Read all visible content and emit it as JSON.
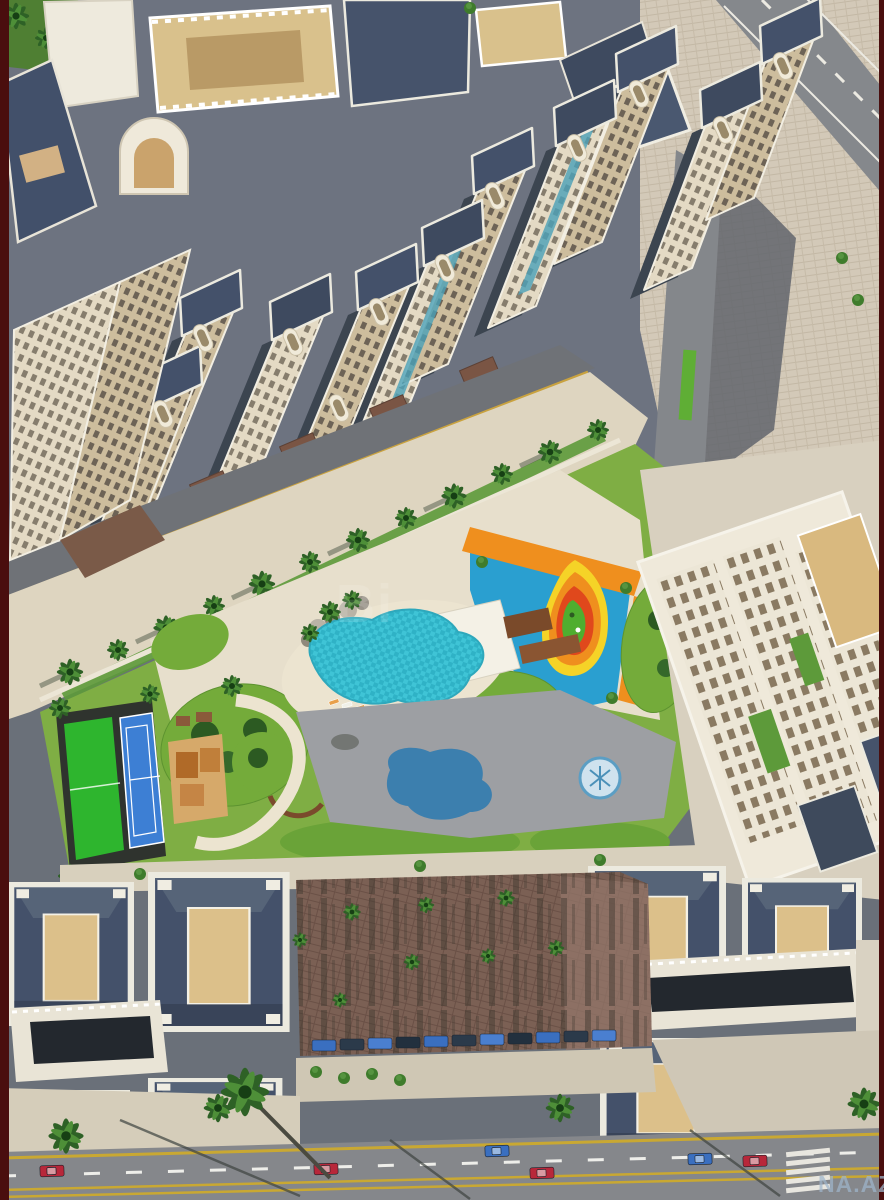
{
  "scene": {
    "type": "aerial-3d-render",
    "subject": "residential-complex-masterplan",
    "elements": [
      "high-rise-towers",
      "palm-promenade",
      "swimming-pool",
      "kids-playground",
      "tennis-court",
      "mini-football-pitch",
      "lawn-mounds",
      "paved-plaza",
      "right-residential-building",
      "parking-plaza",
      "bottom-street",
      "crosswalk"
    ]
  },
  "watermarks": {
    "center": "Bi",
    "bottom_right": "NA.AZ"
  },
  "palette": {
    "frame_maroon": "#4a0e0e",
    "roof_slate": "#44516a",
    "facade_beige": "#cdbd9d",
    "facade_cream": "#e9e3d3",
    "deck_tan": "#dcc08a",
    "lawn_green": "#7fae44",
    "pool_turquoise": "#3fc4d6",
    "tennis_blue": "#3d7fd4",
    "pitch_green": "#2eb52e",
    "playground_blue": "#2a9fd0",
    "playground_orange": "#ef8f1e",
    "playground_yellow": "#f5d327",
    "playground_red": "#e0481c",
    "road_gray": "#85878b",
    "plaza_brown": "#7b6054",
    "pavement_cream": "#ddd5c0",
    "watermark_blue": "#9fb6cc"
  }
}
